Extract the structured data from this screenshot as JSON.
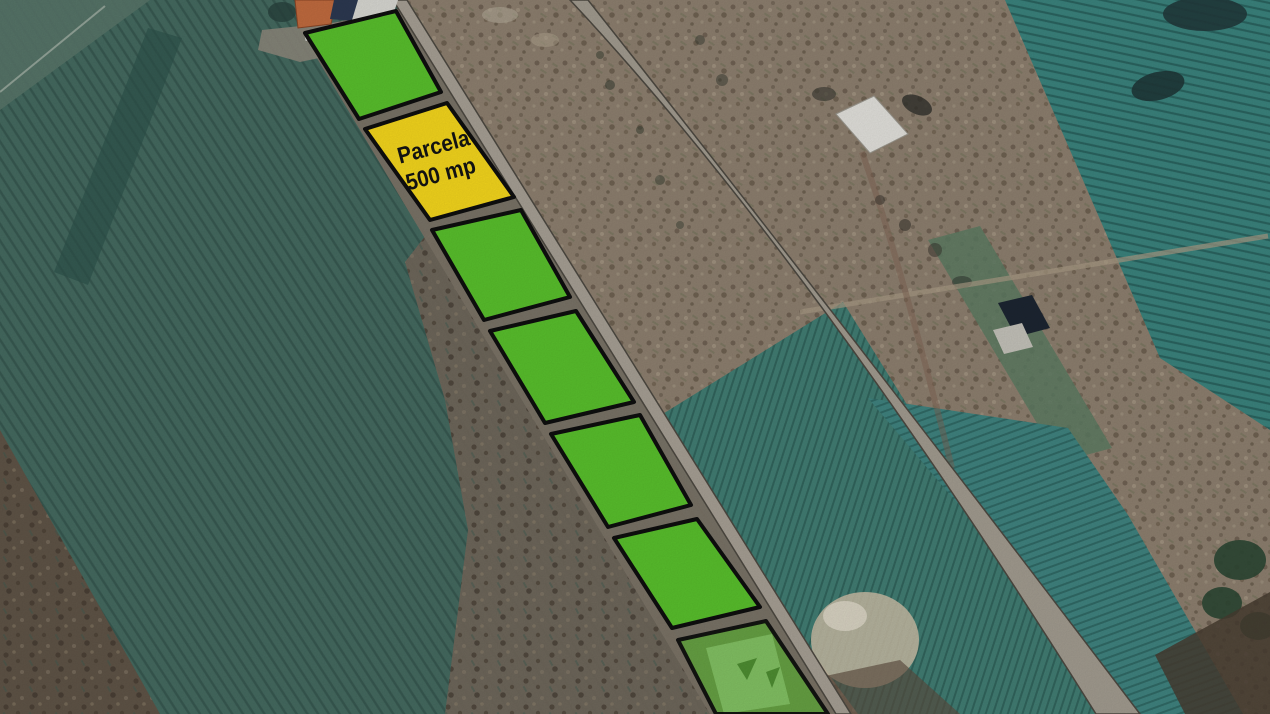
{
  "map_overlay": {
    "highlighted_parcel": {
      "label_line1": "Parcela",
      "label_line2": "500 mp",
      "fill_color": "#f2d41c"
    },
    "parcel_fill_color": "#58be2c",
    "parcel_border_color": "#0e0e0e",
    "parcels_total": 7,
    "parcels_green_opaque": 5,
    "parcels_yellow": 1,
    "parcels_semi_transparent": 1,
    "road_color": "#a39d92"
  }
}
